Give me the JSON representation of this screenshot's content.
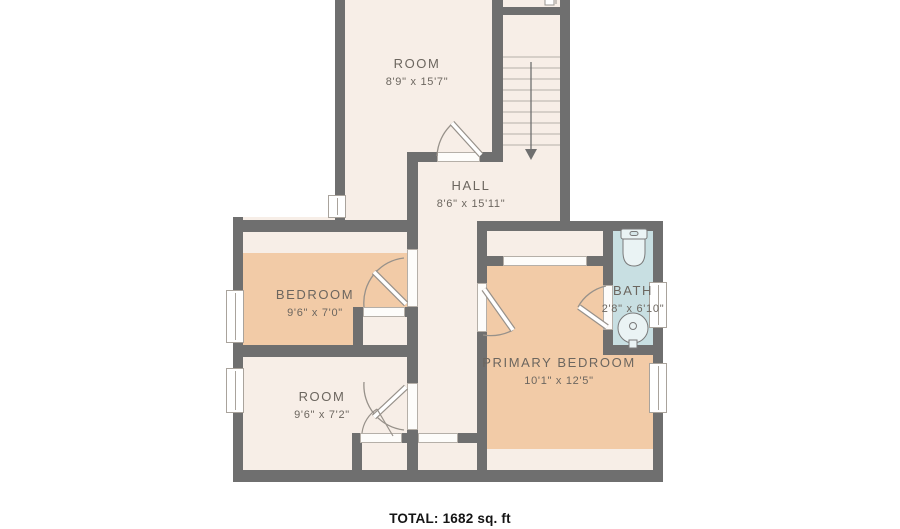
{
  "floorplan": {
    "total_label": "TOTAL: 1682 sq. ft",
    "rooms": [
      {
        "name": "ROOM",
        "dims": "8'9\" x 15'7\""
      },
      {
        "name": "HALL",
        "dims": "8'6\" x 15'11\""
      },
      {
        "name": "BEDROOM",
        "dims": "9'6\" x 7'0\""
      },
      {
        "name": "ROOM",
        "dims": "9'6\" x 7'2\""
      },
      {
        "name": "PRIMARY BEDROOM",
        "dims": "10'1\" x 12'5\""
      },
      {
        "name": "BATH",
        "dims": "2'8\" x 6'10\""
      }
    ],
    "stairs": {
      "direction": "down",
      "treads": 10
    },
    "fixtures": [
      "toilet",
      "sink"
    ],
    "colors": {
      "wall": "#6f6f6f",
      "floor": "#f7eee7",
      "carpet": "#f2cba7",
      "bath_floor": "#c8dfe2",
      "window": "#ffffff",
      "label_text": "#6c665f",
      "total_text": "#141414",
      "background": "#ffffff"
    }
  }
}
